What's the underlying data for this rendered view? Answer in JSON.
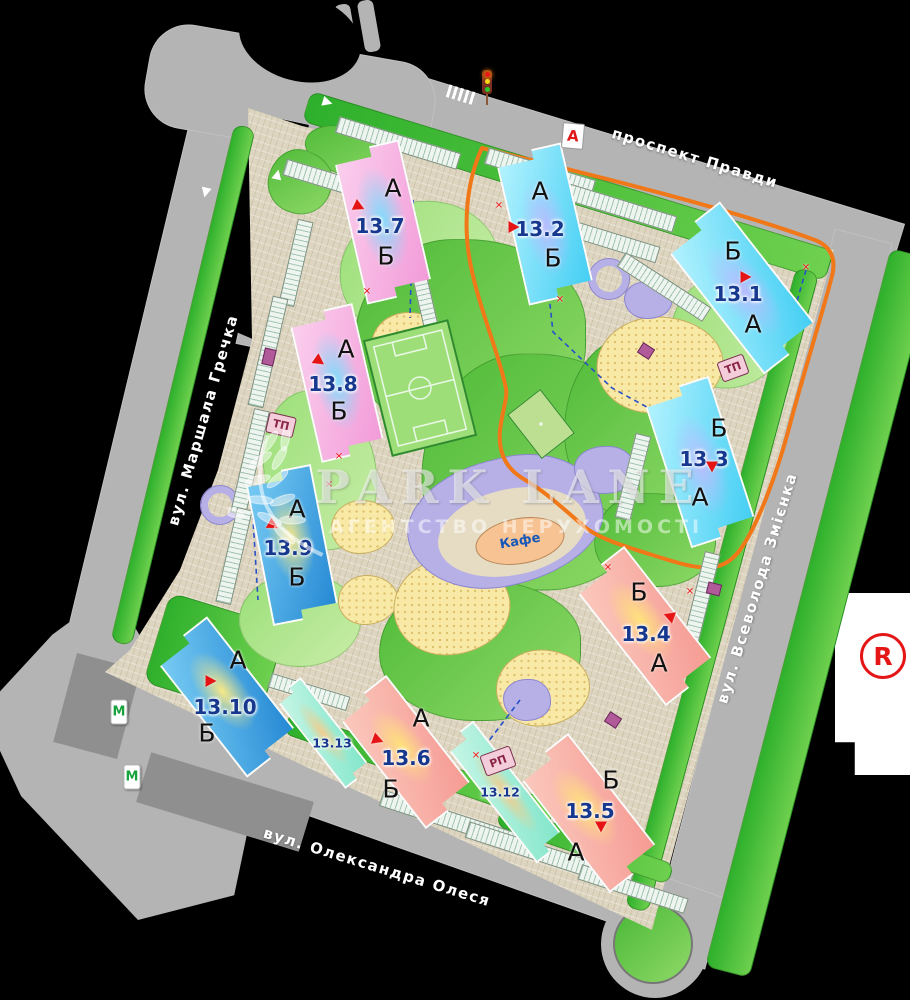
{
  "canvas": {
    "width": 910,
    "height": 1000
  },
  "streets": [
    {
      "id": "prospekt-pravdy",
      "name": "проспект Правди"
    },
    {
      "id": "vul-marshala-hrechka",
      "name": "вул. Маршала Гречка"
    },
    {
      "id": "vul-vsevoloda-zmiienka",
      "name": "вул. Всеволода Змієнка"
    },
    {
      "id": "vul-oleksandra-olesia",
      "name": "вул. Олександра Олеся"
    }
  ],
  "buildings": [
    {
      "number": "13.7",
      "top": "А",
      "bottom": "Б"
    },
    {
      "number": "13.2",
      "top": "А",
      "bottom": "Б"
    },
    {
      "number": "13.1",
      "top": "Б",
      "bottom": "А"
    },
    {
      "number": "13.8",
      "top": "А",
      "bottom": "Б"
    },
    {
      "number": "13.3",
      "top": "Б",
      "bottom": "А"
    },
    {
      "number": "13.9",
      "top": "А",
      "bottom": "Б"
    },
    {
      "number": "13.4",
      "top": "Б",
      "bottom": "А"
    },
    {
      "number": "13.10",
      "top": "А",
      "bottom": "Б"
    },
    {
      "number": "13.13"
    },
    {
      "number": "13.6",
      "top": "А",
      "bottom": "Б"
    },
    {
      "number": "13.12"
    },
    {
      "number": "13.5",
      "top": "Б",
      "bottom": "А"
    }
  ],
  "markers": {
    "transformer": "ТП",
    "distribution": "РП",
    "metro": "М",
    "cafe": "Кафе",
    "route_sign": "А",
    "registered": "R"
  },
  "watermark": {
    "brand": "PARK LANE",
    "subtitle": "АГЕНТСТВО НЕРУХОМОСТІ"
  },
  "glyphs": {
    "x_mark": "✕"
  },
  "icons": {
    "entrance_arrow": "red-triangle",
    "boundary_cross": "red-x-mark",
    "traffic_light": "red-yellow-green-signal",
    "direction_arrow": "white-road-arrow",
    "laurel_branch": "watermark-laurel",
    "football_field": "soccer-pitch",
    "roundabout_island": "green-circle"
  },
  "colors": {
    "route_orange": "#f07818",
    "number_text": "#16388e",
    "road_gray": "#b4b4b4",
    "metro_green": "#17a23b",
    "sign_red": "#e41616",
    "site_beige": "#ded5c0"
  }
}
